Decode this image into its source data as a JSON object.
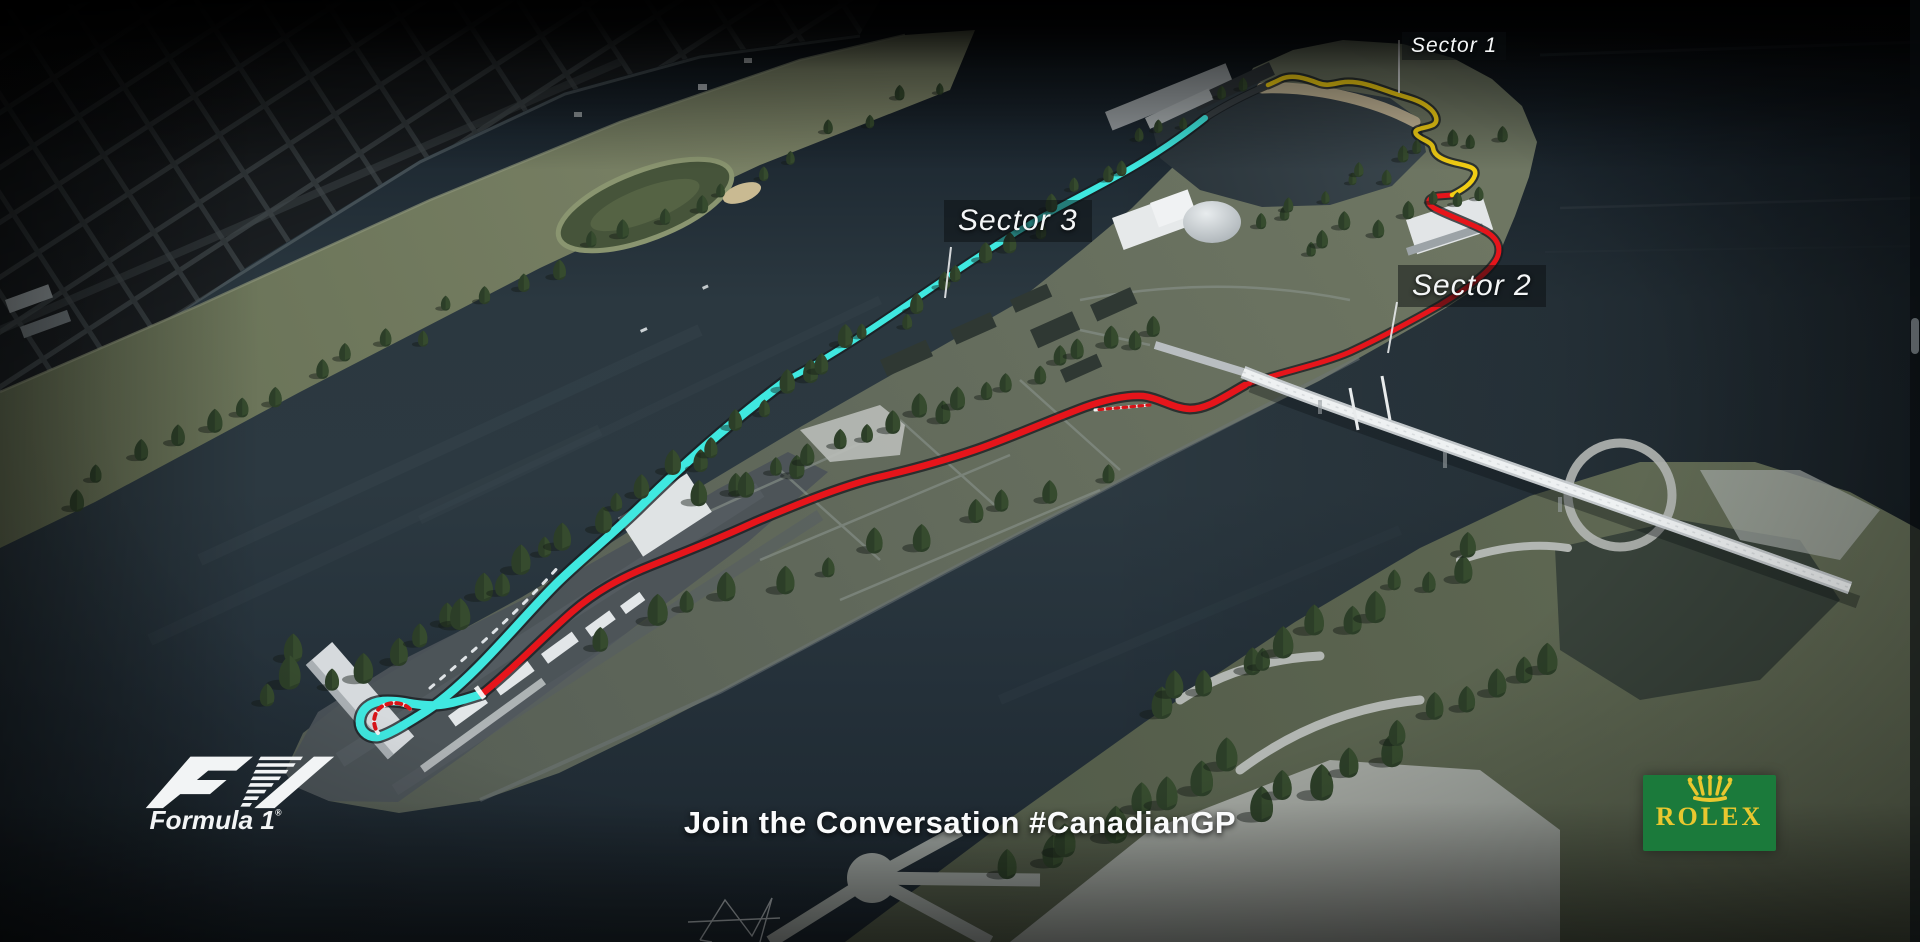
{
  "scene": {
    "sector_labels": {
      "sector1": "Sector 1",
      "sector2": "Sector 2",
      "sector3": "Sector 3"
    }
  },
  "footer": {
    "cta": "Join the Conversation #CanadianGP"
  },
  "branding": {
    "f1_wordmark": "Formula 1",
    "f1_reg_mark": "®",
    "rolex_wordmark": "ROLEX"
  },
  "track_colors": {
    "sector1": "#F2CE14",
    "sector2": "#E6151B",
    "sector3": "#3FE8E0"
  },
  "brand_colors": {
    "rolex_green": "#1B7A3B",
    "rolex_gold": "#E9C72F"
  }
}
